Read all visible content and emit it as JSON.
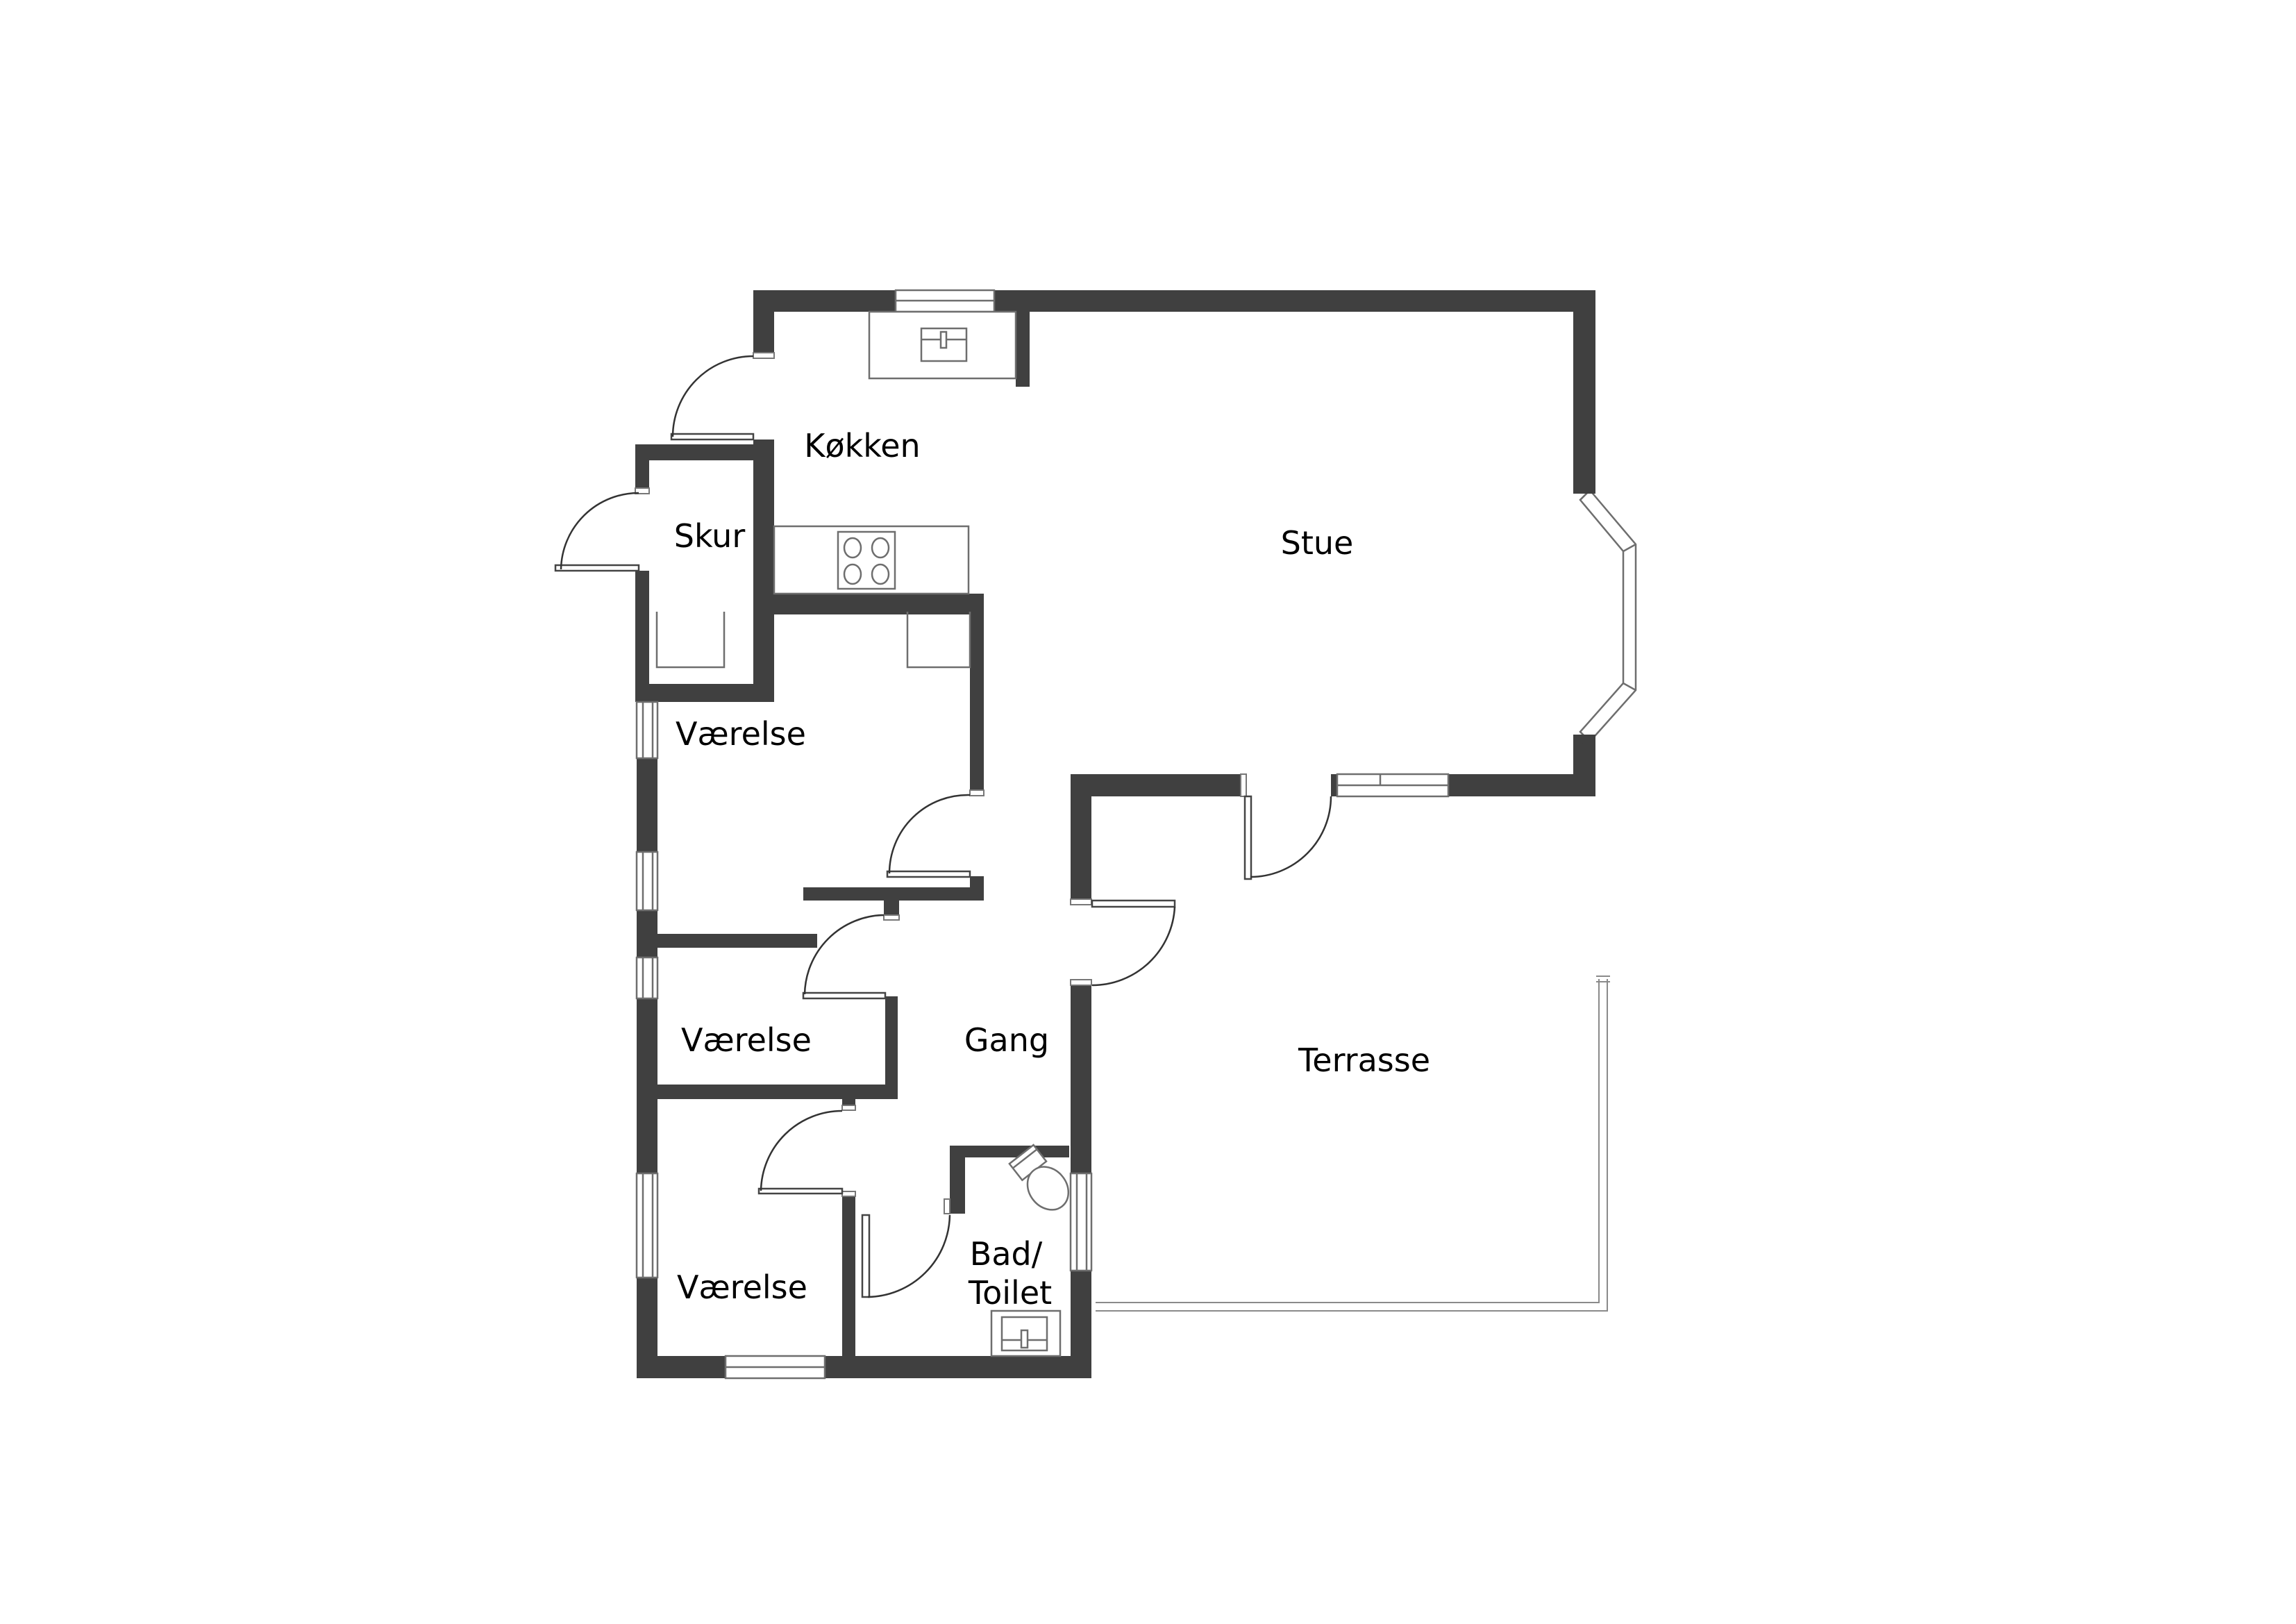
{
  "title": "Floor plan",
  "colors": {
    "wall": "#404040",
    "line": "#6e6e6e",
    "text": "#000000",
    "background": "#ffffff"
  },
  "rooms": [
    {
      "id": "koekken",
      "label": "Køkken"
    },
    {
      "id": "skur",
      "label": "Skur"
    },
    {
      "id": "stue",
      "label": "Stue"
    },
    {
      "id": "vaerelse1",
      "label": "Værelse"
    },
    {
      "id": "vaerelse2",
      "label": "Værelse"
    },
    {
      "id": "gang",
      "label": "Gang"
    },
    {
      "id": "vaerelse3",
      "label": "Værelse"
    },
    {
      "id": "bad",
      "label_line1": "Bad/",
      "label_line2": "Toilet"
    },
    {
      "id": "terrasse",
      "label": "Terrasse"
    }
  ],
  "fixtures": [
    "kitchen-sink",
    "kitchen-counter-north",
    "kitchen-counter-west",
    "stove-4-burners",
    "closet",
    "closet",
    "toilet",
    "bathroom-sink",
    "bay-window",
    "sliding-door",
    "windows-west-x4",
    "window-north",
    "window-south",
    "window-east",
    "terrace-outline"
  ]
}
